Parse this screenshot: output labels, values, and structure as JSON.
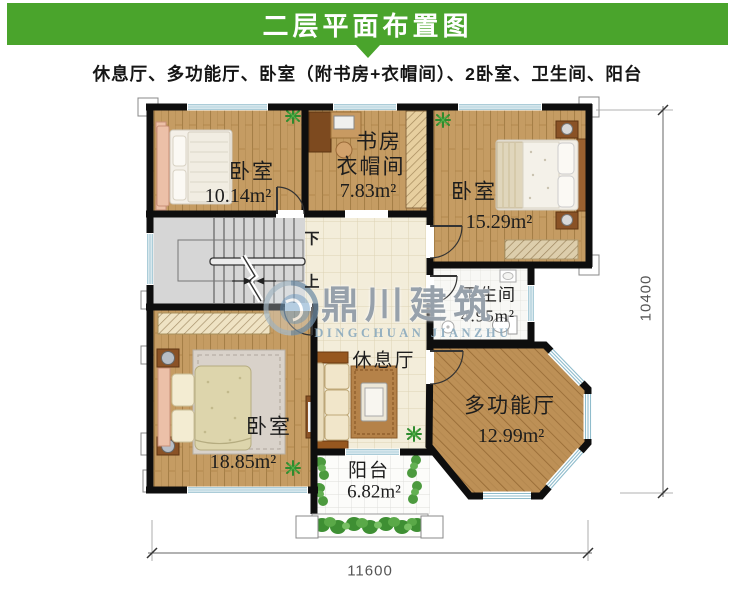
{
  "header": {
    "title": "二层平面布置图"
  },
  "subtitle": "休息厅、多功能厅、卧室（附书房+衣帽间）、2卧室、卫生间、阳台",
  "rooms": {
    "bedroom_top_left": {
      "name": "卧室",
      "area": "10.14m²"
    },
    "study_cloakroom": {
      "line1": "书房",
      "line2": "衣帽间",
      "area": "7.83m²"
    },
    "bedroom_top_right": {
      "name": "卧室",
      "area": "15.29m²"
    },
    "bathroom": {
      "name": "卫生间",
      "area": "4.95m²"
    },
    "rest_hall": {
      "name": "休息厅"
    },
    "multifunction_hall": {
      "name": "多功能厅",
      "area": "12.99m²"
    },
    "bedroom_bottom_left": {
      "name": "卧室",
      "area": "18.85m²"
    },
    "balcony": {
      "name": "阳台",
      "area": "6.82m²"
    }
  },
  "stairs": {
    "down": "下",
    "up": "上"
  },
  "dimensions": {
    "bottom_width": "11600",
    "right_height": "10400"
  },
  "watermark": {
    "zh": "鼎川建筑",
    "en": "DINGCHUAN JIANZHU"
  },
  "colors": {
    "header_green": "#4aa42c",
    "wall_black": "#0e0e0e",
    "wood_floor": "#c59c63",
    "wood_floor_dark": "#bd9056",
    "tile_cream": "#f3edda",
    "stairs_gray": "#d6d6d6",
    "window_blue": "#8fbccc"
  }
}
